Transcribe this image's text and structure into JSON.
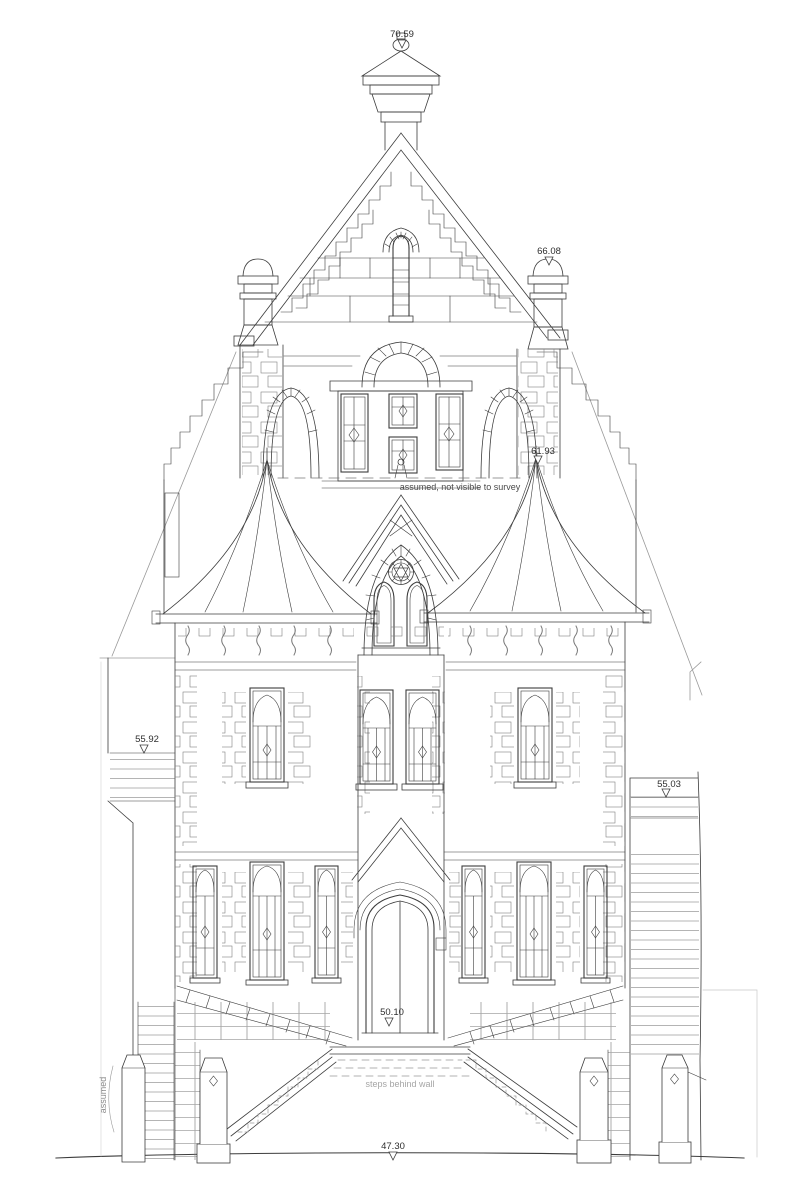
{
  "drawing": {
    "type": "architectural-elevation-survey",
    "levels": [
      {
        "name": "spire-finial-level",
        "value": "70.59"
      },
      {
        "name": "chimney-level",
        "value": "66.08"
      },
      {
        "name": "turret-apex-level",
        "value": "61.93"
      },
      {
        "name": "left-wall-level",
        "value": "55.92"
      },
      {
        "name": "right-wall-level",
        "value": "55.03"
      },
      {
        "name": "door-threshold-level",
        "value": "50.10"
      },
      {
        "name": "ground-level",
        "value": "47.30"
      }
    ],
    "notes": {
      "roof_note": "assumed, not visible to survey",
      "steps_note": "steps behind wall",
      "assumed_note": "assumed"
    },
    "colors": {
      "line": "#3c3c3c",
      "faint": "#9a9a9a",
      "note": "#a6a6a6",
      "background": "#ffffff"
    }
  }
}
